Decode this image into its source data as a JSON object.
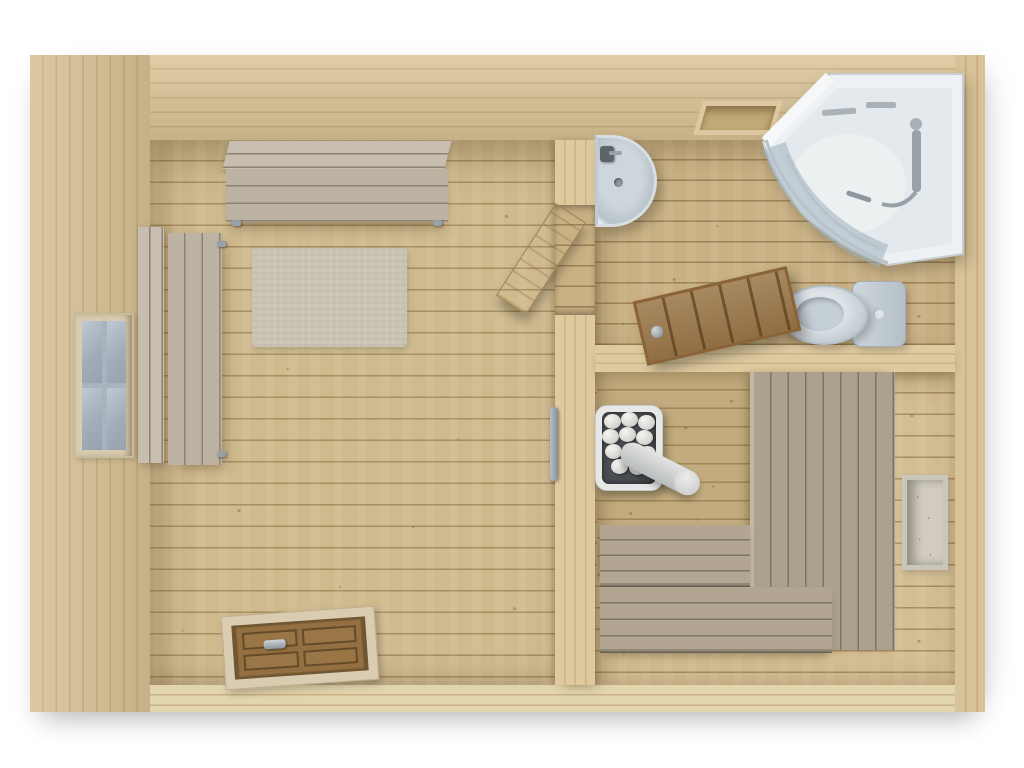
{
  "scene": {
    "type": "3d-architectural-floor-plan-render",
    "subject": "Wooden sauna cabin interior viewed from directly above",
    "background": "#ffffff",
    "text_visible": ""
  },
  "colors": {
    "wall-wood": "#dcc79c",
    "wall-line": "#c9b185",
    "wall-face": "#d8c398",
    "wall-face-line": "#c4ac7d",
    "floor-wood": "#cfba8e",
    "floor-line": "#a68c5f",
    "bath-floor": "#c9b184",
    "bath-line": "#9b8156",
    "sauna-floor": "#d3bd92",
    "north-face": "#c2ab7e",
    "north-line": "#a08756",
    "bench-wood": "#bcb3a3",
    "bench-line": "#8e8374",
    "bench-back": "#c7beaf",
    "tier-wood": "#b2a693",
    "tier-line": "#7f7465",
    "tier-top": "#aca08e",
    "rug": "#cac3b4",
    "heater-rim": "#e6e7e6",
    "heater-body": "#4a4e52",
    "stone": "#e9e9e5",
    "pipe": "#d6d8d8",
    "white-fixture": "#eef1f3",
    "fixture-shade": "#b7c1c9",
    "glass": "#9fb0bd",
    "chrome": "#99a1a8",
    "door-brown": "#9c784a",
    "door-groove": "#77572f",
    "frame-wood": "#d9ccb1",
    "window-glass": "#a9b3bf"
  },
  "rooms": {
    "lounge": {
      "id": "lounge-room",
      "fixtures": [
        "window",
        "wall-bench-with-backrest",
        "side-bench-with-backrest",
        "floor-rug",
        "entrance-door-in-south-wall",
        "open-interior-door",
        "sauna-door-handle-on-partition"
      ]
    },
    "washroom": {
      "id": "washroom",
      "fixtures": [
        "corner-sink-with-faucet",
        "corner-shower-cabin-curved-glass",
        "toilet",
        "wall-hatch-vent",
        "open-wooden-sauna-door"
      ]
    },
    "sauna": {
      "id": "sauna-room",
      "fixtures": [
        "sauna-heater-with-stones-and-flue",
        "upper-bench-tier",
        "middle-bench-tier",
        "lower-bench-tier",
        "east-wall-niche"
      ],
      "heater": {
        "stone_count": 11
      }
    }
  }
}
